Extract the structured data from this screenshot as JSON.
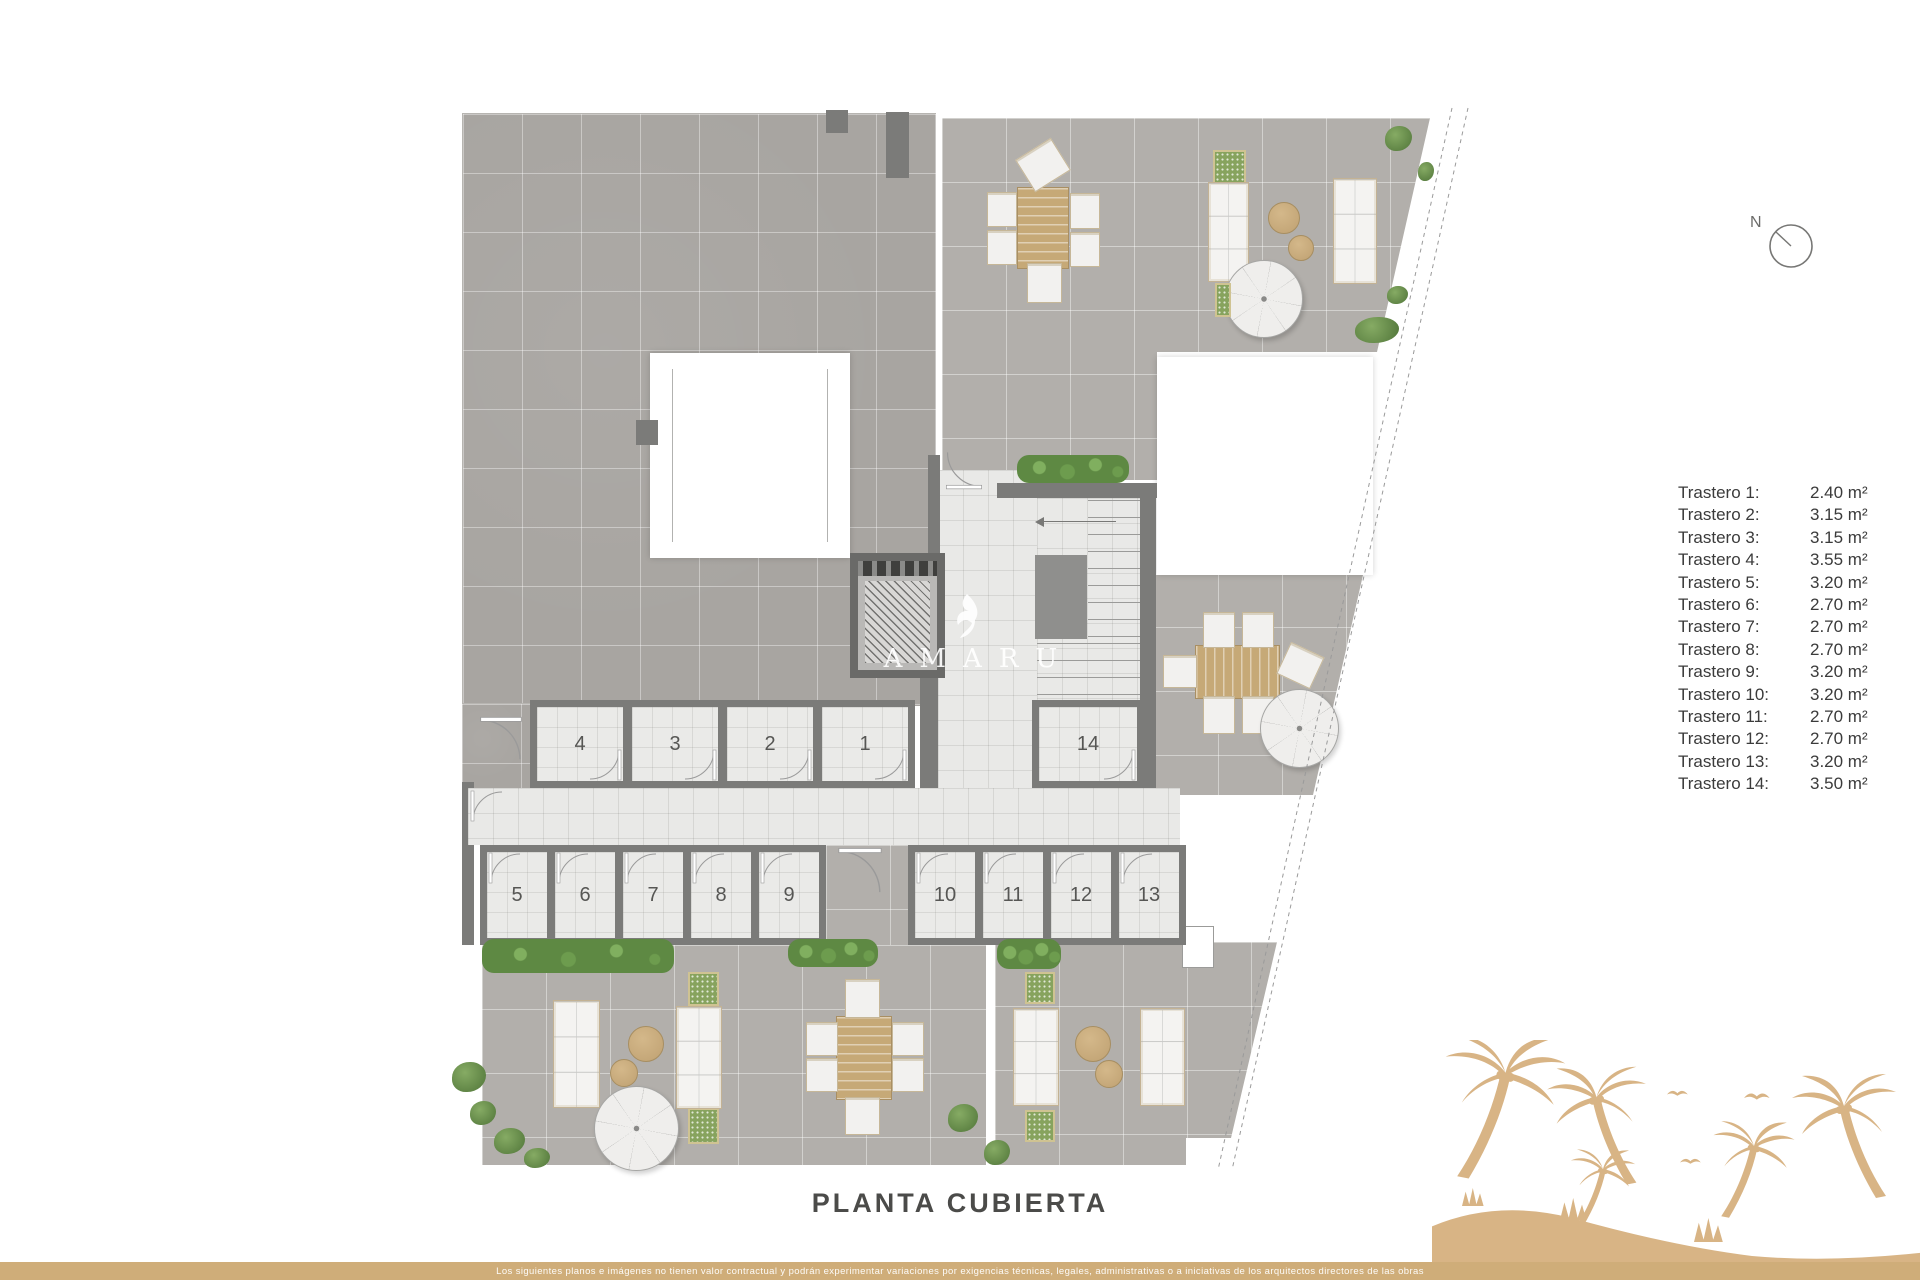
{
  "page": {
    "title": "PLANTA CUBIERTA",
    "disclaimer": "Los siguientes planos e imágenes no tienen valor contractual y podrán experimentar variaciones por exigencias técnicas, legales, administrativas o a iniciativas de los arquitectos directores de las obras"
  },
  "compass": {
    "label": "N"
  },
  "watermark": {
    "brand": "AMARU"
  },
  "legend": {
    "items": [
      {
        "label": "Trastero 1:",
        "value": "2.40 m²"
      },
      {
        "label": "Trastero 2:",
        "value": "3.15 m²"
      },
      {
        "label": "Trastero 3:",
        "value": "3.15 m²"
      },
      {
        "label": "Trastero 4:",
        "value": "3.55 m²"
      },
      {
        "label": "Trastero 5:",
        "value": "3.20 m²"
      },
      {
        "label": "Trastero 6:",
        "value": "2.70 m²"
      },
      {
        "label": "Trastero 7:",
        "value": "2.70 m²"
      },
      {
        "label": "Trastero 8:",
        "value": "2.70 m²"
      },
      {
        "label": "Trastero 9:",
        "value": "3.20 m²"
      },
      {
        "label": "Trastero 10:",
        "value": "3.20 m²"
      },
      {
        "label": "Trastero 11:",
        "value": "2.70 m²"
      },
      {
        "label": "Trastero 12:",
        "value": "2.70 m²"
      },
      {
        "label": "Trastero 13:",
        "value": "3.20 m²"
      },
      {
        "label": "Trastero 14:",
        "value": "3.50 m²"
      }
    ]
  },
  "plan": {
    "rooms": {
      "top_row": [
        "4",
        "3",
        "2",
        "1"
      ],
      "right_room": "14",
      "bottom_left_row": [
        "5",
        "6",
        "7",
        "8",
        "9"
      ],
      "bottom_right_row": [
        "10",
        "11",
        "12",
        "13"
      ]
    }
  },
  "colors": {
    "accent_gold": "#cfad79",
    "palm_gold": "#d8b485",
    "wall_gray": "#7b7b79",
    "roof_tile_dark": "#a8a5a1",
    "terrace_tile": "#b2afab",
    "light_tile": "#e9e9e7",
    "text_dark": "#3b3b3b"
  }
}
